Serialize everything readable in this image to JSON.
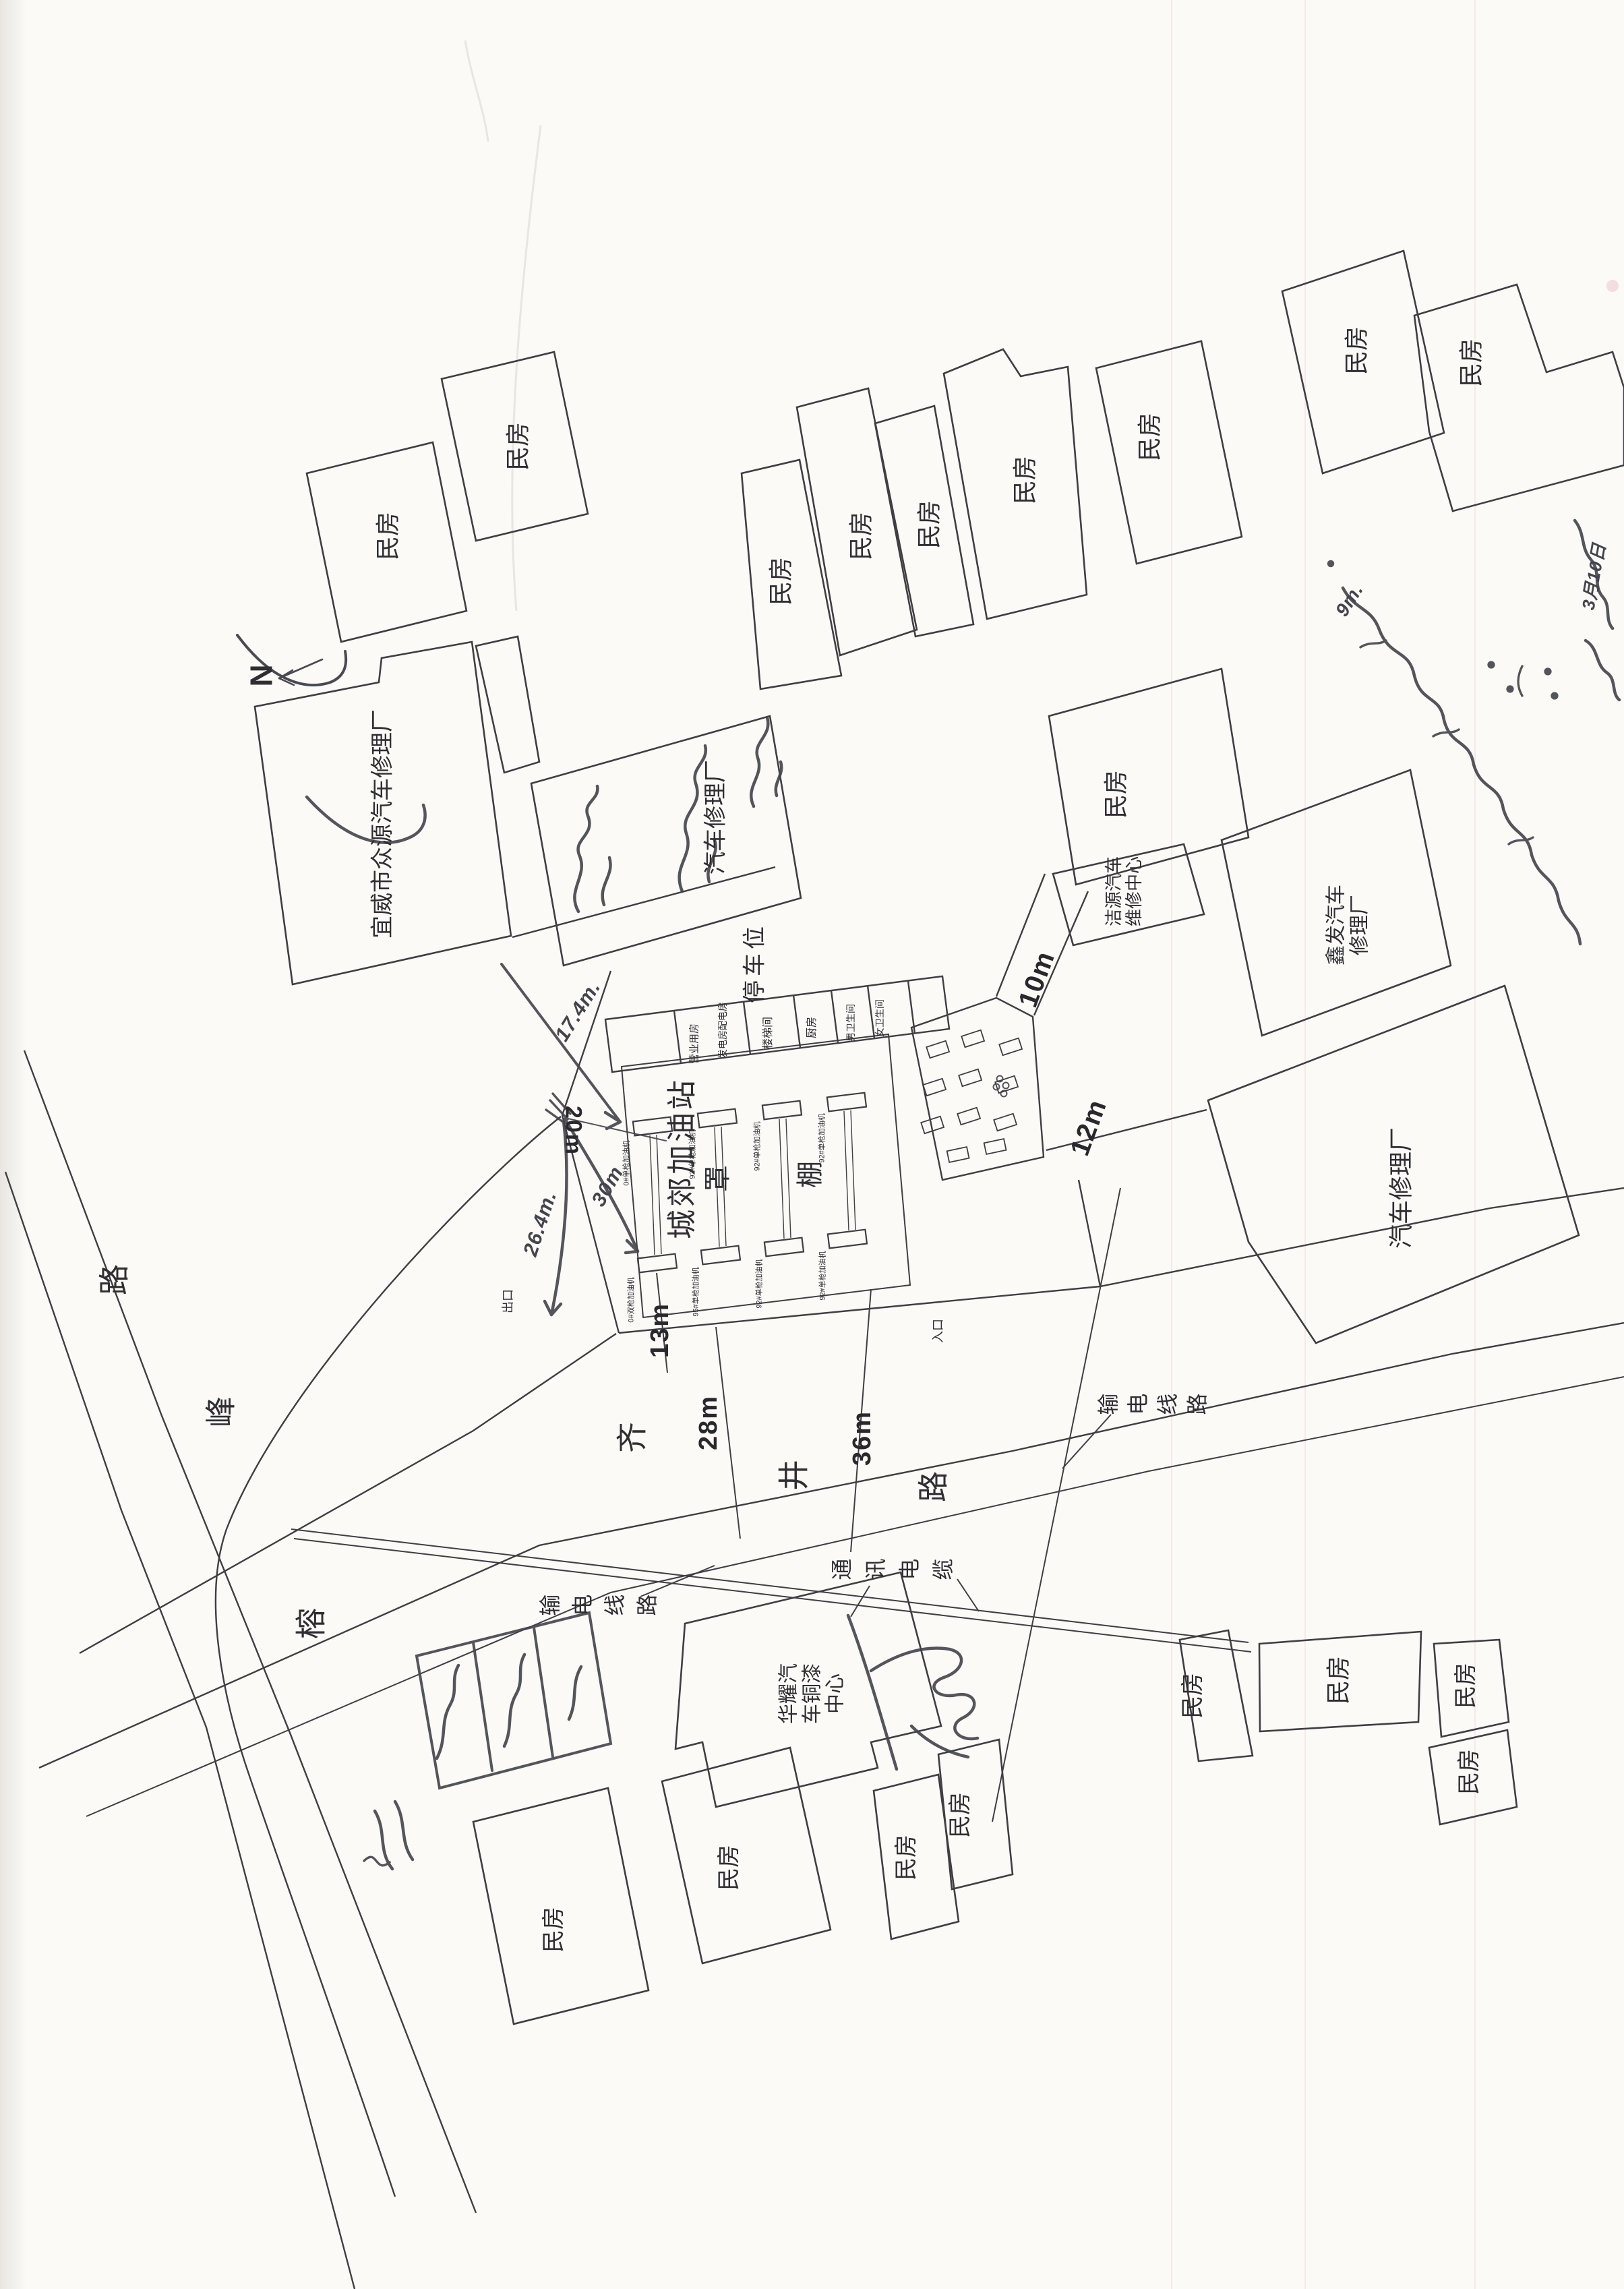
{
  "compass": {
    "north_label": "N"
  },
  "labels": {
    "residential": "民房",
    "parking": "停车位",
    "entrance": "入口",
    "exit": "出口",
    "station_name": "城郊加油站",
    "canopy_char_1": "罩",
    "canopy_char_2": "棚",
    "power_line": "输电线路",
    "comm_cable": "通讯电缆"
  },
  "facilities": {
    "yiwei_repair": "宜威市众源汽车修理厂",
    "mid_repair": "汽车修理厂",
    "right_repair": "汽车修理厂",
    "jieyuan_line1": "洁源汽车",
    "jieyuan_line2": "维修中心",
    "xinfa_line1": "鑫发汽车",
    "xinfa_line2": "修理厂",
    "huayao_line1": "华耀汽",
    "huayao_line2": "车铜漆",
    "huayao_line3": "中心"
  },
  "station_rooms": {
    "business": "营业用房",
    "generator": "发电房配电房",
    "stair": "楼梯间",
    "kitchen": "厨房",
    "toilet_m": "男卫生间",
    "toilet_f": "女卫生间"
  },
  "dispensers": {
    "top": [
      "0#单枪加油机",
      "92#单枪加油机",
      "92#单枪加油机",
      "92#单枪加油机"
    ],
    "bottom": [
      "0#双枪加油机",
      "95#单枪加油机",
      "92#单枪加油机",
      "92#单枪加油机"
    ]
  },
  "roads": {
    "qijing": [
      "齐",
      "井",
      "路"
    ],
    "rongfeng": [
      "榕",
      "峰",
      "路"
    ]
  },
  "measurements": {
    "m10": "10m",
    "m12": "12m",
    "m13": "13m",
    "m20": "20m",
    "m28": "28m",
    "m36": "36m"
  },
  "handwritten": {
    "m17": "17.4m.",
    "m26": "26.4m.",
    "m30": "30m",
    "m9": "9m.",
    "date_note": "3月10日"
  }
}
